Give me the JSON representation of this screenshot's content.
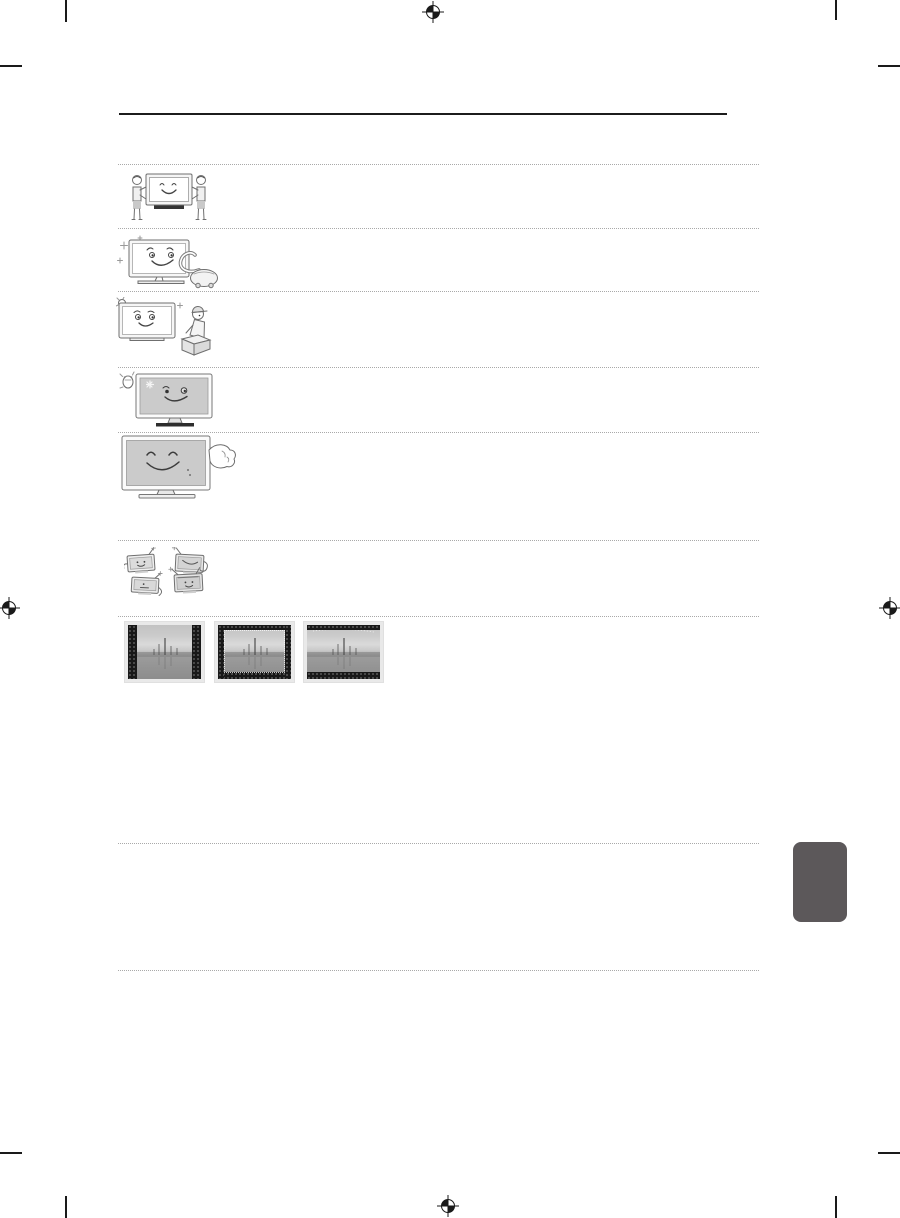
{
  "page": {
    "kind": "print-manual-page-graphics-only",
    "background": "#ffffff",
    "visible_text": ""
  },
  "colors": {
    "title_rule": "#1c1c1c",
    "dotted_separator": "#a9a9a9",
    "print_mark": "#1a1a1a",
    "side_tab": "#5c585a",
    "tv_screen_gray": "#cbcbcb",
    "thumb_frame": "#e9e9e9",
    "thumb_bar_black": "#181818"
  },
  "illustrations": [
    {
      "name": "two-people-carrying-tv-illustration"
    },
    {
      "name": "tv-with-vacuum-cleaner-cleaning-illustration"
    },
    {
      "name": "tv-with-service-technician-and-box-illustration"
    },
    {
      "name": "waving-hand-and-winking-tv-illustration"
    },
    {
      "name": "hand-patting-smiling-tv-illustration"
    },
    {
      "name": "four-cartoon-tvs-illustration"
    }
  ],
  "screen_examples": [
    {
      "name": "pillarbox-screen-example",
      "bars": "left-right"
    },
    {
      "name": "windowbox-screen-example",
      "bars": "all-sides"
    },
    {
      "name": "letterbox-screen-example",
      "bars": "top-bottom"
    }
  ],
  "print_marks": {
    "registration_marks": [
      "top-center",
      "left-middle",
      "right-middle",
      "bottom-center"
    ],
    "crop_mark_corners": [
      "top-left",
      "top-right",
      "bottom-left",
      "bottom-right"
    ]
  },
  "separators": {
    "count": 9
  }
}
